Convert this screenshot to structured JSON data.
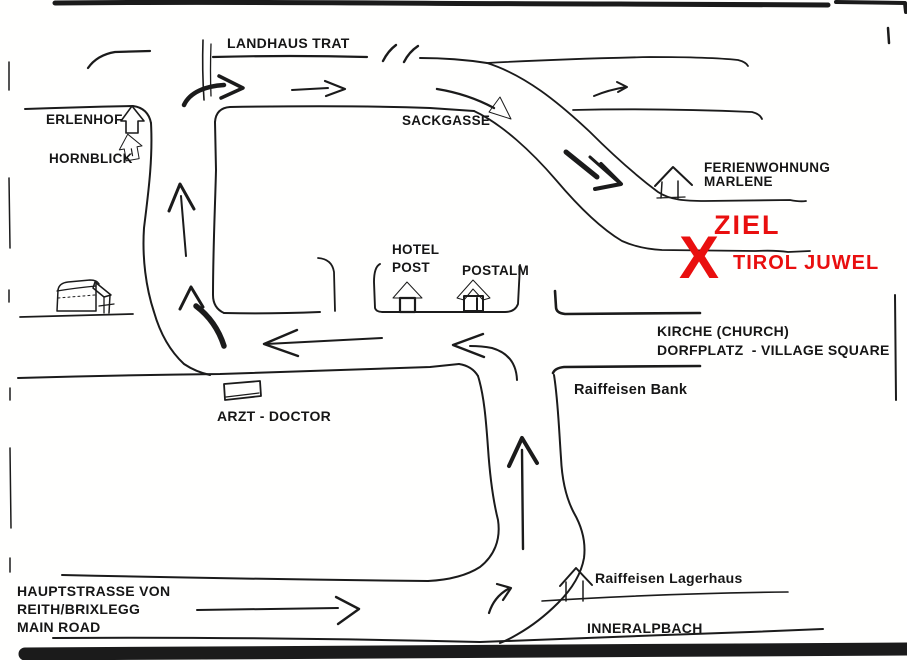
{
  "document": {
    "type": "scanned hand-drawn direction sketch map",
    "destination": "Tirol Juwel"
  },
  "colors": {
    "ink": "#1b1b1b",
    "highlight_red": "#e90f0f",
    "paper": "#fffffe",
    "scan_edge": "#0a0a0a"
  },
  "labels": {
    "landhaus_trat": "LANDHAUS TRAT",
    "erlenhof": "ERLENHOF",
    "hornblick": "HORNBLICK",
    "sackgasse": "SACKGASSE",
    "ferienwohnung": "FERIENWOHNUNG",
    "marlene": "MARLENE",
    "ziel": "ZIEL",
    "x_mark": "X",
    "tirol_juwel": "TIROL JUWEL",
    "hotel": "HOTEL",
    "post": "POST",
    "postalm": "POSTALM",
    "kirche": "KIRCHE (CHURCH)",
    "dorfplatz": "DORFPLATZ  - VILLAGE SQUARE",
    "raiffeisen_bank": "Raiffeisen Bank",
    "arzt_doctor": "ARZT - DOCTOR",
    "hauptstrasse_1": "HAUPTSTRASSE VON",
    "hauptstrasse_2": "REITH/BRIXLEGG",
    "hauptstrasse_3": "MAIN ROAD",
    "raiffeisen_lagerhaus": "Raiffeisen Lagerhaus",
    "inneralpbach": "INNERALPBACH"
  },
  "icons": [
    "house-outline-icon (Erlenhof)",
    "house-filled-icon (Hornblick)",
    "house-filled-roof-icon (Hotel Post)",
    "house-door-icon (Postalm)",
    "house-roof-icon (Ferienwohnung Marlene)",
    "house-roof-icon (Raiffeisen Lagerhaus)",
    "barn-sketch-icon",
    "rectangle-building-icon (Arzt)",
    "x-destination-mark"
  ],
  "route_arrows": {
    "count": 12,
    "directions": [
      "east along main road (bottom)",
      "turn north from main road",
      "north up village branch",
      "west along village road (2 arrows)",
      "turn north into loop road",
      "north up loop road",
      "turn east onto top road",
      "east along top road (2 marks)",
      "curve southeast into Sackgasse",
      "southeast toward Ziel"
    ]
  }
}
